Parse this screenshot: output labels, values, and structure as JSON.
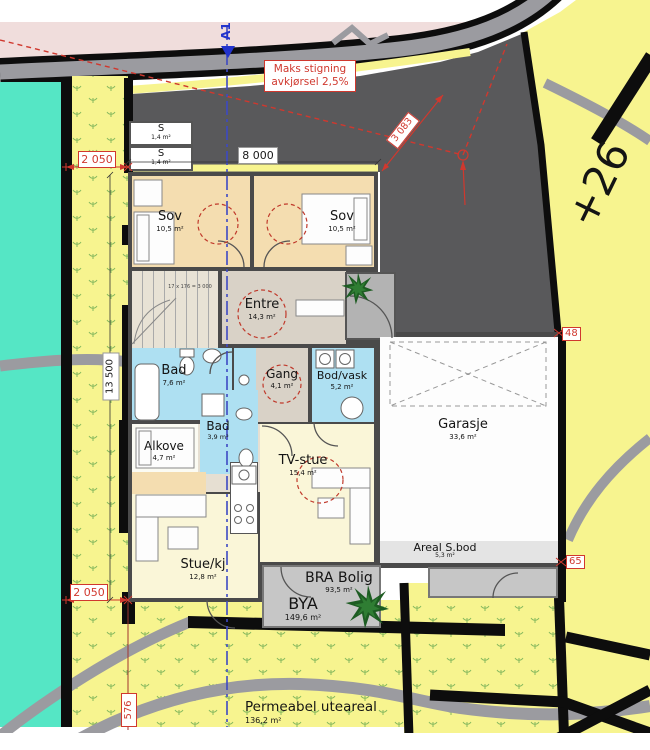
{
  "drawing": {
    "section_marker": "A1",
    "driveway_note_line1": "Maks stigning",
    "driveway_note_line2": "avkjørsel 2,5%",
    "elevation_label": "+26",
    "stair_note": "17 x 176 = 3 000",
    "boundary_points": [
      {
        "label": "48"
      },
      {
        "label": "65"
      }
    ]
  },
  "rooms": [
    {
      "name": "S",
      "area": "1,4 m²"
    },
    {
      "name": "S",
      "area": "1,4 m²"
    },
    {
      "name": "Sov",
      "area": "10,5 m²"
    },
    {
      "name": "Sov",
      "area": "10,5 m²"
    },
    {
      "name": "Entre",
      "area": "14,3 m²"
    },
    {
      "name": "Bad",
      "area": "7,6 m²"
    },
    {
      "name": "Gang",
      "area": "4,1 m²"
    },
    {
      "name": "Bod/vask",
      "area": "5,2 m²"
    },
    {
      "name": "Bad",
      "area": "3,9 m²"
    },
    {
      "name": "Alkove",
      "area": "4,7 m²"
    },
    {
      "name": "TV-stue",
      "area": "15,4 m²"
    },
    {
      "name": "Stue/kj",
      "area": "12,8 m²"
    },
    {
      "name": "Garasje",
      "area": "33,6 m²"
    },
    {
      "name": "Areal S.bod",
      "area": "5,3 m²"
    }
  ],
  "site_areas": [
    {
      "name": "BRA Bolig",
      "area": "93,5 m²"
    },
    {
      "name": "BYA",
      "area": "149,6 m²"
    },
    {
      "name": "Permeabel uteareal",
      "area": "136,2 m²"
    }
  ],
  "dimensions": {
    "top_offset": "2 050",
    "driveway_width": "8 000",
    "house_length": "13 500",
    "bottom_offset": "2 050",
    "path_offset": "576",
    "diagonal": "3 083"
  },
  "colors": {
    "parcel_yellow": "#f7f48f",
    "neighbor_teal": "#55e6c5",
    "road_pink": "#f0dddc",
    "driveway_gray": "#59595b",
    "road_gray": "#9b9ba0",
    "bedroom_tan": "#f4ddb0",
    "bath_blue": "#aee0f2",
    "living_yellow": "#faf6d8",
    "entre_beige": "#d9d2c7",
    "terrace_gray": "#c6c6c6",
    "wall_gray": "#4a4a4a",
    "annotation_red": "#d0382e",
    "section_blue": "#3d49c4",
    "grass_green": "#86b95e"
  }
}
